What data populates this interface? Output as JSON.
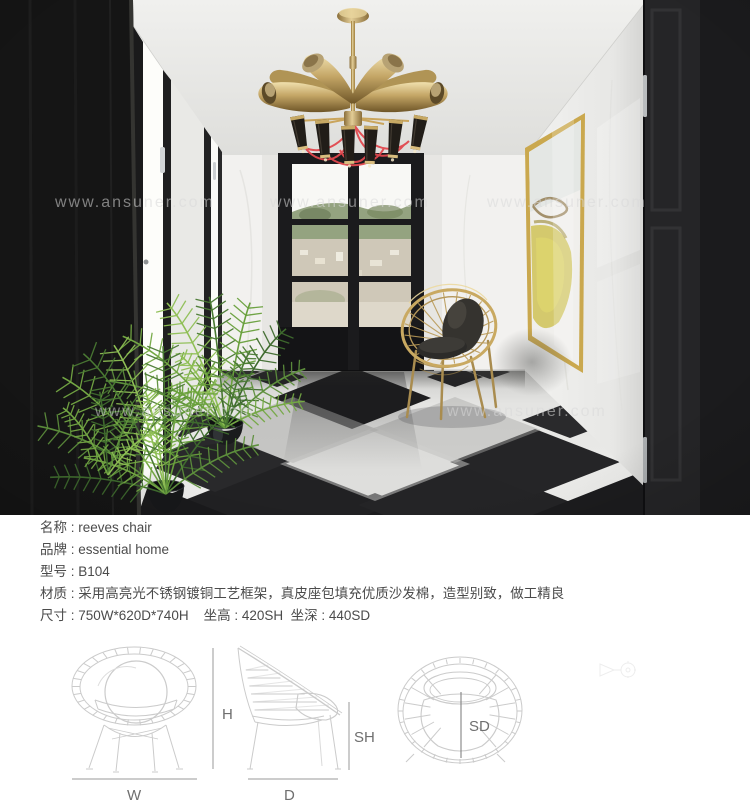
{
  "photo": {
    "watermark_text": "www.ansuner.com"
  },
  "spec_lines": [
    "名称 : reeves chair",
    "品牌 : essential home",
    "型号 : B104",
    "材质 : 采用高亮光不锈钢镀铜工艺框架，真皮座包填充优质沙发棉，造型别致，做工精良",
    "尺寸 : 750W*620D*740H    坐高 : 420SH  坐深 : 440SD"
  ],
  "diagram_labels": {
    "height": "H",
    "width": "W",
    "depth": "D",
    "seat_height": "SH",
    "seat_depth": "SD"
  },
  "colors": {
    "brass": "#b5975a",
    "brass_light": "#dcc38c",
    "wire_red": "#e2484e",
    "floor_dark": "#1e1e20",
    "floor_light": "#e9e9e7",
    "wall_white": "#f0f0ee",
    "door_black": "#1b1b1d",
    "plant_green": "#5d8f3c",
    "art_yellow": "#cdbf4e",
    "cushion_dark": "#35332f",
    "spec_text": "#4b4b4b",
    "diagram_line": "#c9c9c9"
  }
}
